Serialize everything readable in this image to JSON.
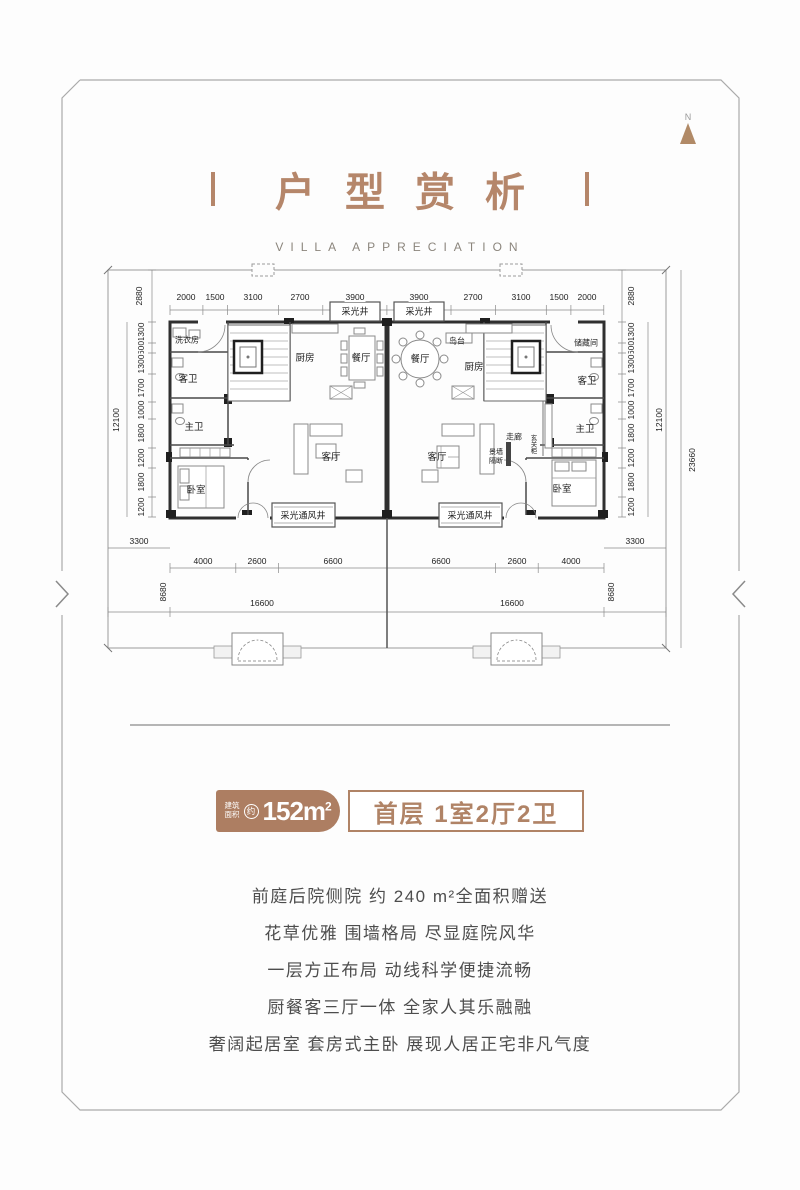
{
  "colors": {
    "accent_tan": "#b5866a",
    "badge_brown": "#ad7e62",
    "badge_border": "#b08366",
    "text_gray": "#4d4d4d"
  },
  "compass": {
    "label": "N"
  },
  "header": {
    "title": "户型赏析",
    "subtitle": "VILLA APPRECIATION"
  },
  "badge": {
    "area_prefix_top": "建筑",
    "area_prefix_bottom": "面积",
    "area_circle": "约",
    "area_value": "152m",
    "area_sup": "2",
    "unit_info": "首层 1室2厅2卫"
  },
  "features": [
    "前庭后院侧院 约 240 m²全面积赠送",
    "花草优雅 围墙格局 尽显庭院风华",
    "一层方正布局 动线科学便捷流畅",
    "厨餐客三厅一体 全家人其乐融融",
    "奢阔起居室 套房式主卧 展现人居正宅非凡气度"
  ],
  "floorplan": {
    "dim_labels": [
      {
        "v": "2000",
        "x": 186,
        "y": 297
      },
      {
        "v": "1500",
        "x": 215,
        "y": 297
      },
      {
        "v": "3100",
        "x": 253,
        "y": 297
      },
      {
        "v": "2700",
        "x": 300,
        "y": 297
      },
      {
        "v": "3900",
        "x": 355,
        "y": 297
      },
      {
        "v": "3900",
        "x": 419,
        "y": 297
      },
      {
        "v": "2700",
        "x": 473,
        "y": 297
      },
      {
        "v": "3100",
        "x": 521,
        "y": 297
      },
      {
        "v": "1500",
        "x": 559,
        "y": 297
      },
      {
        "v": "2000",
        "x": 587,
        "y": 297
      },
      {
        "v": "2880",
        "x": 139,
        "y": 296,
        "rot": 1
      },
      {
        "v": "2880",
        "x": 631,
        "y": 296,
        "rot": 1
      },
      {
        "v": "1300",
        "x": 141,
        "y": 332,
        "rot": 1
      },
      {
        "v": "600",
        "x": 141,
        "y": 348,
        "rot": 1
      },
      {
        "v": "1300",
        "x": 141,
        "y": 364,
        "rot": 1
      },
      {
        "v": "1700",
        "x": 141,
        "y": 388,
        "rot": 1
      },
      {
        "v": "1000",
        "x": 141,
        "y": 410,
        "rot": 1
      },
      {
        "v": "1800",
        "x": 141,
        "y": 433,
        "rot": 1
      },
      {
        "v": "1200",
        "x": 141,
        "y": 458,
        "rot": 1
      },
      {
        "v": "1800",
        "x": 141,
        "y": 482,
        "rot": 1
      },
      {
        "v": "1200",
        "x": 141,
        "y": 507,
        "rot": 1
      },
      {
        "v": "1300",
        "x": 631,
        "y": 332,
        "rot": 1
      },
      {
        "v": "600",
        "x": 631,
        "y": 348,
        "rot": 1
      },
      {
        "v": "1300",
        "x": 631,
        "y": 364,
        "rot": 1
      },
      {
        "v": "1700",
        "x": 631,
        "y": 388,
        "rot": 1
      },
      {
        "v": "1000",
        "x": 631,
        "y": 410,
        "rot": 1
      },
      {
        "v": "1800",
        "x": 631,
        "y": 433,
        "rot": 1
      },
      {
        "v": "1200",
        "x": 631,
        "y": 458,
        "rot": 1
      },
      {
        "v": "1800",
        "x": 631,
        "y": 482,
        "rot": 1
      },
      {
        "v": "1200",
        "x": 631,
        "y": 507,
        "rot": 1
      },
      {
        "v": "12100",
        "x": 116,
        "y": 420,
        "rot": 1
      },
      {
        "v": "12100",
        "x": 659,
        "y": 420,
        "rot": 1
      },
      {
        "v": "23660",
        "x": 692,
        "y": 460,
        "rot": 1
      },
      {
        "v": "3300",
        "x": 139,
        "y": 541
      },
      {
        "v": "3300",
        "x": 635,
        "y": 541
      },
      {
        "v": "4000",
        "x": 203,
        "y": 561
      },
      {
        "v": "2600",
        "x": 257,
        "y": 561
      },
      {
        "v": "6600",
        "x": 333,
        "y": 561
      },
      {
        "v": "6600",
        "x": 441,
        "y": 561
      },
      {
        "v": "2600",
        "x": 517,
        "y": 561
      },
      {
        "v": "4000",
        "x": 571,
        "y": 561
      },
      {
        "v": "8680",
        "x": 163,
        "y": 592,
        "rot": 1
      },
      {
        "v": "8680",
        "x": 611,
        "y": 592,
        "rot": 1
      },
      {
        "v": "16600",
        "x": 262,
        "y": 603
      },
      {
        "v": "16600",
        "x": 512,
        "y": 603
      }
    ],
    "room_labels": [
      {
        "t": "洗衣房",
        "x": 187,
        "y": 340,
        "fs": 8
      },
      {
        "t": "客卫",
        "x": 188,
        "y": 378
      },
      {
        "t": "主卫",
        "x": 194,
        "y": 426
      },
      {
        "t": "卧室",
        "x": 196,
        "y": 489
      },
      {
        "t": "厨房",
        "x": 305,
        "y": 357
      },
      {
        "t": "餐厅",
        "x": 361,
        "y": 357
      },
      {
        "t": "客厅",
        "x": 331,
        "y": 456
      },
      {
        "t": "采光井",
        "x": 355,
        "y": 311,
        "fs": 9
      },
      {
        "t": "采光井",
        "x": 419,
        "y": 311,
        "fs": 9
      },
      {
        "t": "餐厅",
        "x": 420,
        "y": 358
      },
      {
        "t": "岛台",
        "x": 457,
        "y": 341,
        "fs": 8
      },
      {
        "t": "厨房",
        "x": 474,
        "y": 366
      },
      {
        "t": "客厅",
        "x": 437,
        "y": 456
      },
      {
        "t": "走廊",
        "x": 514,
        "y": 437,
        "fs": 8
      },
      {
        "t": "景墙",
        "x": 496,
        "y": 452,
        "fs": 7
      },
      {
        "t": "隔断",
        "x": 496,
        "y": 461,
        "fs": 7
      },
      {
        "t": "玄关柜",
        "x": 532,
        "y": 444,
        "fs": 6.5,
        "vert": 1
      },
      {
        "t": "储藏间",
        "x": 586,
        "y": 343,
        "fs": 8
      },
      {
        "t": "客卫",
        "x": 587,
        "y": 380
      },
      {
        "t": "主卫",
        "x": 585,
        "y": 428
      },
      {
        "t": "卧室",
        "x": 562,
        "y": 488
      },
      {
        "t": "采光通风井",
        "x": 303,
        "y": 515,
        "fs": 9
      },
      {
        "t": "采光通风井",
        "x": 470,
        "y": 515,
        "fs": 9
      }
    ]
  }
}
